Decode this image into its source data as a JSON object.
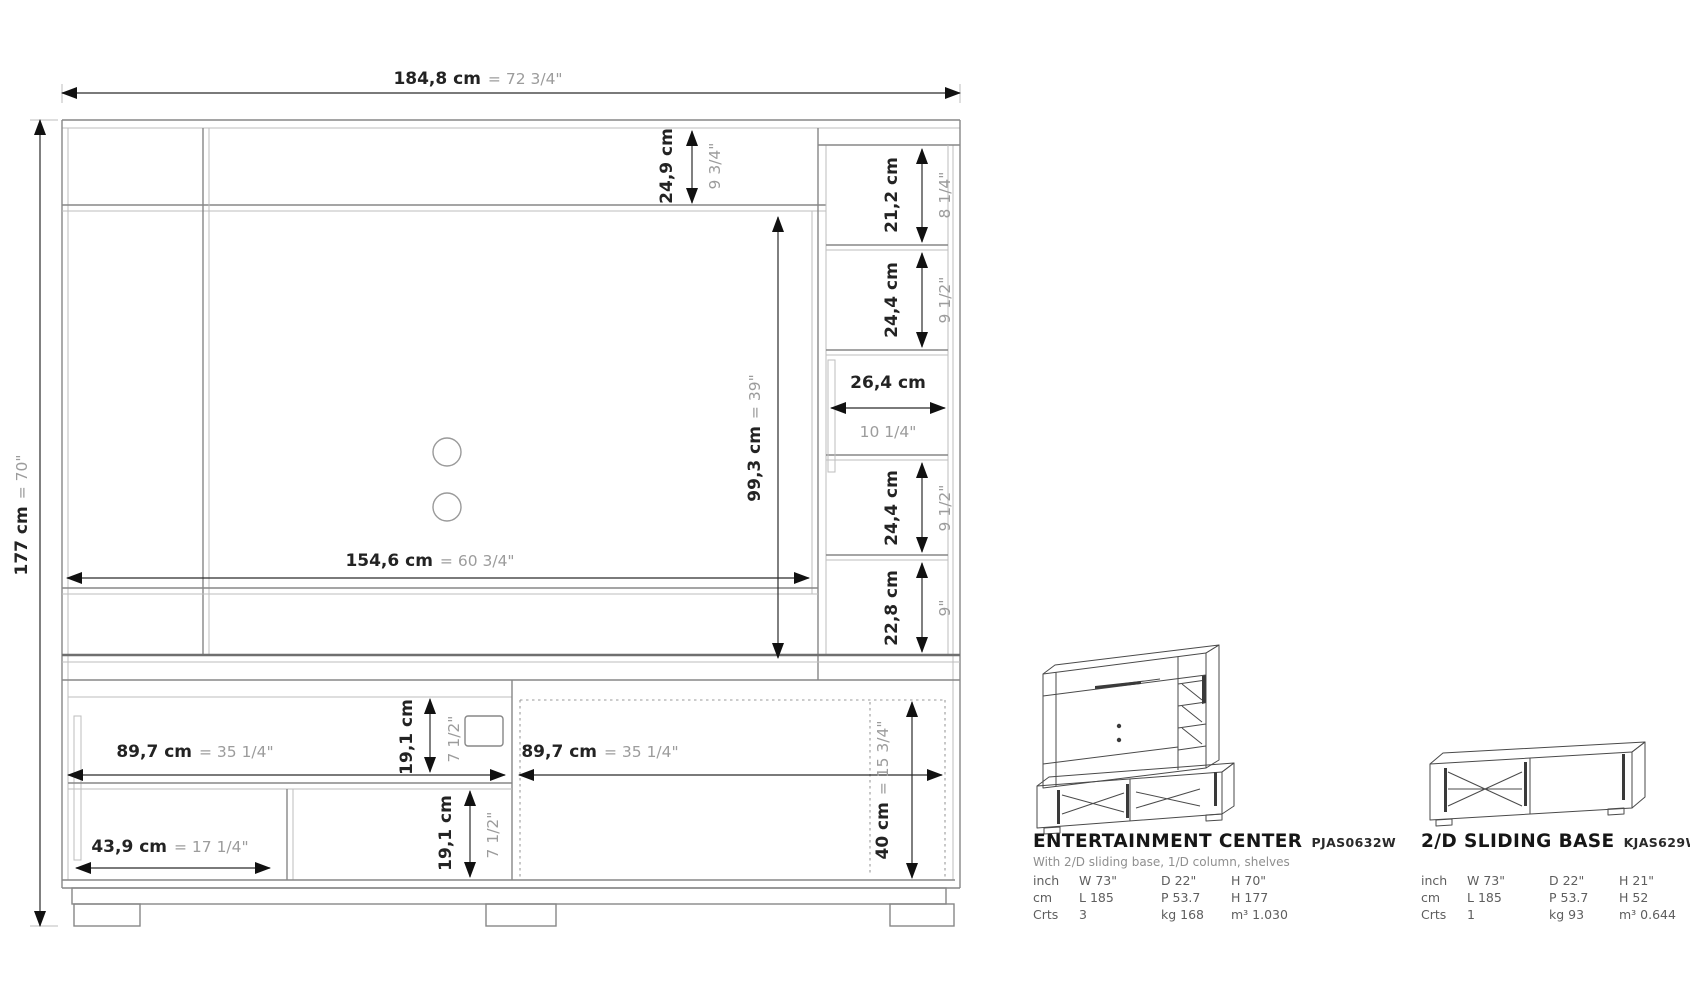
{
  "dims": {
    "overall_width": {
      "cm": "184,8 cm",
      "in": "= 72 3/4\""
    },
    "overall_height": {
      "cm": "177 cm",
      "in": "= 70\""
    },
    "top_shelf": {
      "cm": "24,9 cm",
      "in": "9 3/4\""
    },
    "shelf_top": {
      "cm": "21,2 cm",
      "in": "8 1/4\""
    },
    "shelf_upper": {
      "cm": "24,4 cm",
      "in": "9 1/2\""
    },
    "niche_width": {
      "cm": "26,4 cm",
      "in": "10 1/4\""
    },
    "opening_height": {
      "cm": "99,3 cm",
      "in": "= 39\""
    },
    "shelf_lower": {
      "cm": "24,4 cm",
      "in": "9 1/2\""
    },
    "shelf_bottom": {
      "cm": "22,8 cm",
      "in": "9\""
    },
    "opening_width": {
      "cm": "154,6 cm",
      "in": "= 60 3/4\""
    },
    "door_left": {
      "cm": "89,7 cm",
      "in": "= 35 1/4\""
    },
    "door_right": {
      "cm": "89,7 cm",
      "in": "= 35 1/4\""
    },
    "base_upper": {
      "cm": "19,1 cm",
      "in": "7 1/2\""
    },
    "base_lower": {
      "cm": "19,1 cm",
      "in": "7 1/2\""
    },
    "base_inner": {
      "cm": "43,9 cm",
      "in": "= 17 1/4\""
    },
    "base_height": {
      "cm": "40 cm",
      "in": "= 15 3/4\""
    }
  },
  "products": [
    {
      "name": "ENTERTAINMENT CENTER",
      "code": "PJAS0632W",
      "description": "With 2/D sliding base, 1/D column, shelves",
      "specs": [
        [
          "inch",
          "W 73\"",
          "D 22\"",
          "H 70\""
        ],
        [
          "cm",
          "L 185",
          "P 53.7",
          "H 177"
        ],
        [
          "Crts",
          "3",
          "kg 168",
          "m³ 1.030"
        ]
      ]
    },
    {
      "name": "2/D SLIDING BASE",
      "code": "KJAS629W",
      "description": "",
      "specs": [
        [
          "inch",
          "W 73\"",
          "D 22\"",
          "H 21\""
        ],
        [
          "cm",
          "L 185",
          "P 53.7",
          "H 52"
        ],
        [
          "Crts",
          "1",
          "kg 93",
          "m³ 0.644"
        ]
      ]
    }
  ]
}
